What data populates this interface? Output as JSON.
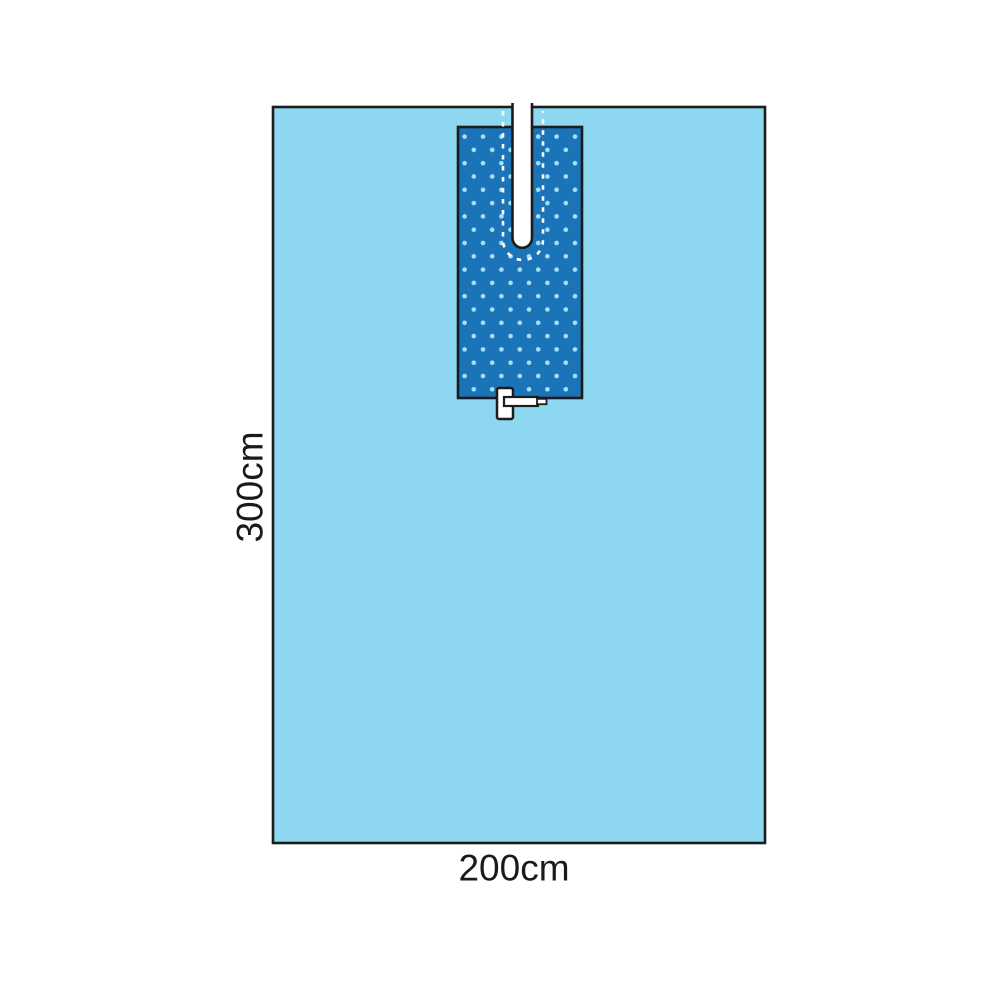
{
  "diagram": {
    "height_label": "300cm",
    "width_label": "200cm"
  },
  "colors": {
    "background": "#FFFFFF",
    "drape_fill": "#8ED7F1",
    "panel_fill": "#1B73B8",
    "dot_color": "#A8DFF5",
    "outline": "#1C1C1C",
    "label_text": "#1A1A1A",
    "slit_fill": "#FFFFFF",
    "dashed_line": "#FFFFFF"
  }
}
